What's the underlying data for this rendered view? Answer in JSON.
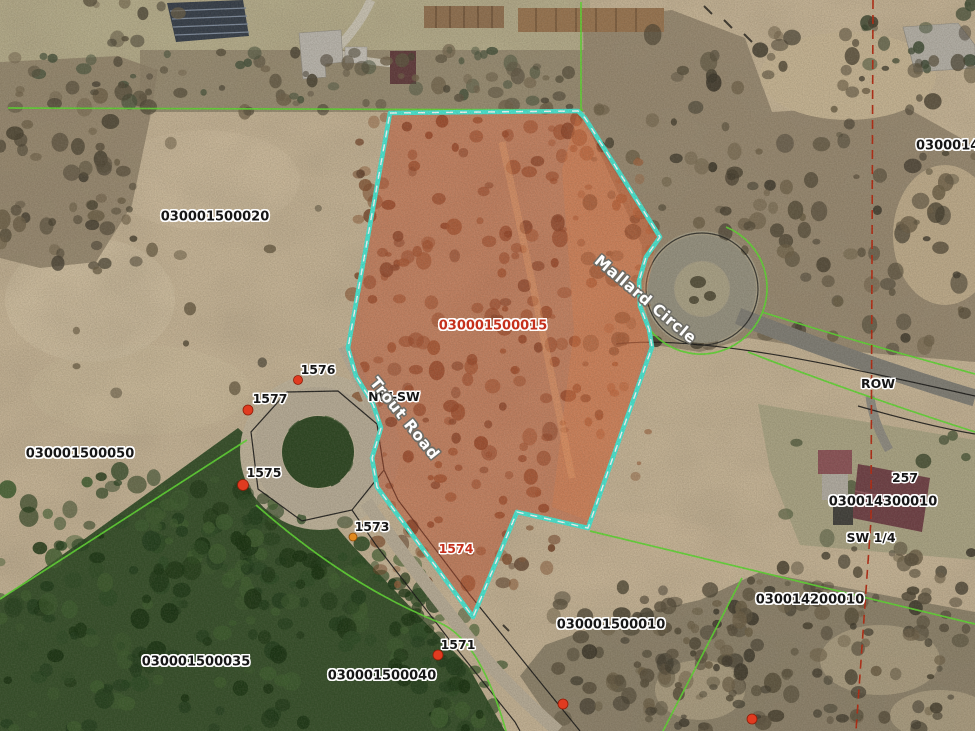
{
  "map": {
    "labels": [
      {
        "id": "parcel-030001500020",
        "text": "030001500020",
        "x": 215,
        "y": 217,
        "style": "id"
      },
      {
        "id": "parcel-030001500015",
        "text": "030001500015",
        "x": 493,
        "y": 326,
        "style": "id-red"
      },
      {
        "id": "parcel-030001500050",
        "text": "030001500050",
        "x": 80,
        "y": 454,
        "style": "id"
      },
      {
        "id": "parcel-030001500035",
        "text": "030001500035",
        "x": 196,
        "y": 662,
        "style": "id"
      },
      {
        "id": "parcel-030001500040",
        "text": "030001500040",
        "x": 382,
        "y": 676,
        "style": "id"
      },
      {
        "id": "parcel-030001500010",
        "text": "030001500010",
        "x": 611,
        "y": 625,
        "style": "id"
      },
      {
        "id": "parcel-030014200010",
        "text": "030014200010",
        "x": 810,
        "y": 600,
        "style": "id"
      },
      {
        "id": "parcel-030014300010",
        "text": "030014300010",
        "x": 883,
        "y": 502,
        "style": "id"
      },
      {
        "id": "parcel-030001490",
        "text": "030001490",
        "x": 916,
        "y": 146,
        "style": "id",
        "anchor": "left"
      },
      {
        "id": "lot-1576",
        "text": "1576",
        "x": 318,
        "y": 370,
        "style": "small"
      },
      {
        "id": "lot-1577",
        "text": "1577",
        "x": 270,
        "y": 399,
        "style": "small"
      },
      {
        "id": "lot-1575",
        "text": "1575",
        "x": 264,
        "y": 473,
        "style": "small"
      },
      {
        "id": "lot-1573",
        "text": "1573",
        "x": 372,
        "y": 527,
        "style": "small"
      },
      {
        "id": "lot-1571",
        "text": "1571",
        "x": 458,
        "y": 645,
        "style": "small"
      },
      {
        "id": "lot-1574",
        "text": "1574",
        "x": 456,
        "y": 549,
        "style": "small-red"
      },
      {
        "id": "house-number-257",
        "text": "257",
        "x": 905,
        "y": 478,
        "style": "small"
      },
      {
        "id": "quarter-section-sw",
        "text": "SW 1/4",
        "x": 871,
        "y": 538,
        "style": "small"
      },
      {
        "id": "row-label",
        "text": "ROW",
        "x": 878,
        "y": 384,
        "style": "small"
      },
      {
        "id": "quarter-nw-sw",
        "text": "NW-SW",
        "x": 394,
        "y": 397,
        "style": "small"
      },
      {
        "id": "road-trout",
        "text": "Trout Road",
        "x": 404,
        "y": 419,
        "style": "road",
        "angle": 51
      },
      {
        "id": "road-mallard",
        "text": "Mallard Circle",
        "x": 645,
        "y": 300,
        "style": "road",
        "angle": 40
      }
    ],
    "styles": {
      "parcel_id_color": "#161616",
      "selected_id_color": "#c5301c",
      "road_label_color": "#ffffff",
      "highlight_outline": "#46e6d1",
      "highlight_fill": "#c14e2c",
      "parcel_line_green": "#5cd830",
      "row_line_black": "#141414",
      "section_line_red": "#b3270f",
      "marker_red": "#e03b20",
      "marker_orange": "#e08a20"
    }
  }
}
